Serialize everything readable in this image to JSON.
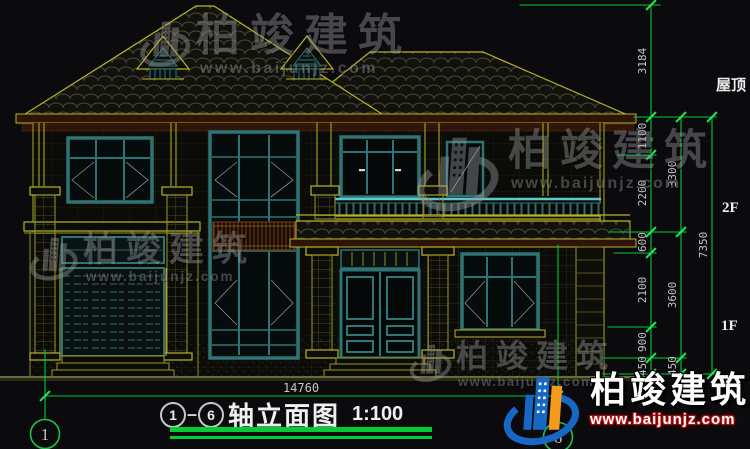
{
  "watermarks": {
    "brand": "柏竣建筑",
    "url": "www.baijunjz.com"
  },
  "title_block": {
    "axis_from": "1",
    "separator": "–",
    "axis_to": "6",
    "title": "轴立面图",
    "scale": "1:100"
  },
  "bottom_dimension": "14760",
  "axis_bubbles": {
    "left": "1",
    "right": "6"
  },
  "level_labels": {
    "roof": "屋顶",
    "second": "2F",
    "first": "1F"
  },
  "dimensions": {
    "inner_chain": [
      "3184",
      "1100",
      "2200",
      "600",
      "2100",
      "900",
      "450"
    ],
    "middle_chain": [
      "3300",
      "3600",
      "450"
    ],
    "overall_chain": [
      "7350"
    ]
  },
  "colors": {
    "background": "#0b0b0e",
    "cad_yellow": "#b9b32c",
    "frame_teal": "#2e7474",
    "dim_green": "#00c83c",
    "logo_blue": "#1668c4",
    "logo_orange": "#f59a1c",
    "url_red": "#b50d0d"
  }
}
